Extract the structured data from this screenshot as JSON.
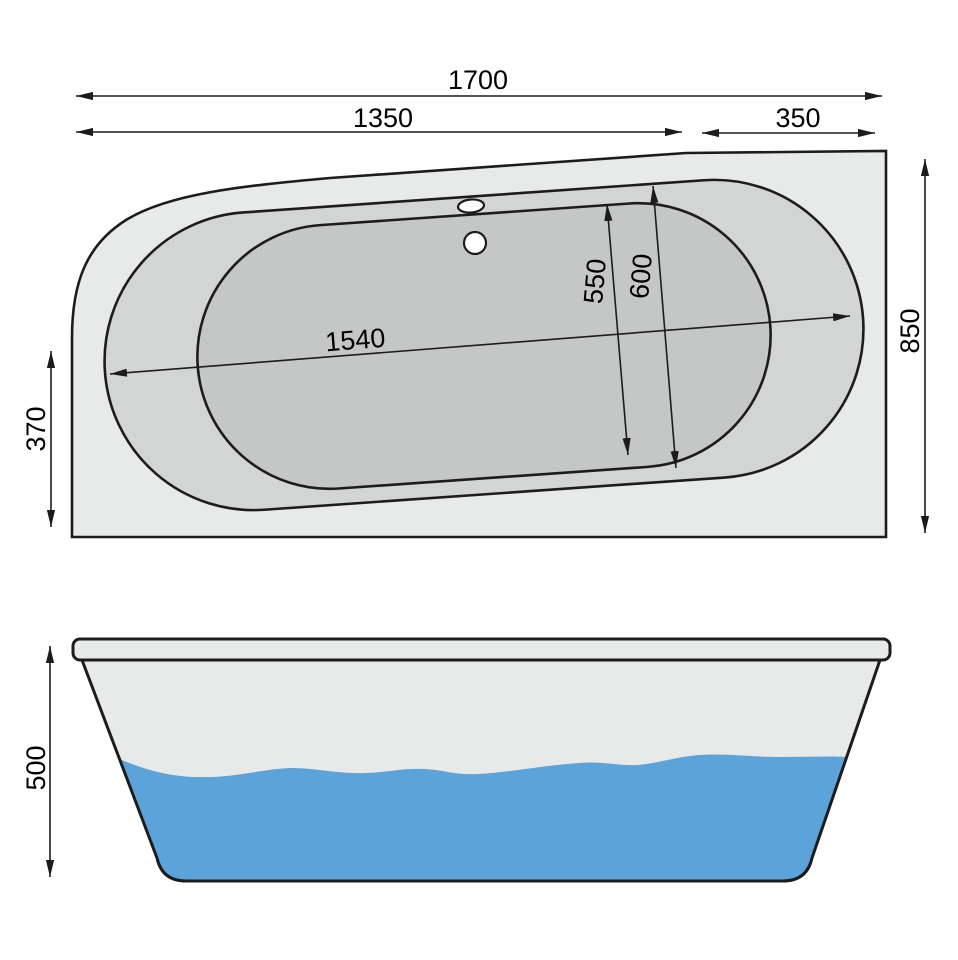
{
  "top_view": {
    "dims": {
      "total_length": "1700",
      "front_section": "1350",
      "end_section": "350",
      "overall_width": "850",
      "side_edge": "370",
      "basin_length": "1540",
      "basin_floor_width": "550",
      "basin_top_width": "600"
    }
  },
  "side_view": {
    "dims": {
      "height": "500"
    }
  },
  "colors": {
    "deck": "#e8eae9",
    "rim_band": "#d3d5d4",
    "basin": "#c5c7c6",
    "water": "#5ba3d9",
    "hole": "#ffffff",
    "outline": "#1c1c1c"
  }
}
